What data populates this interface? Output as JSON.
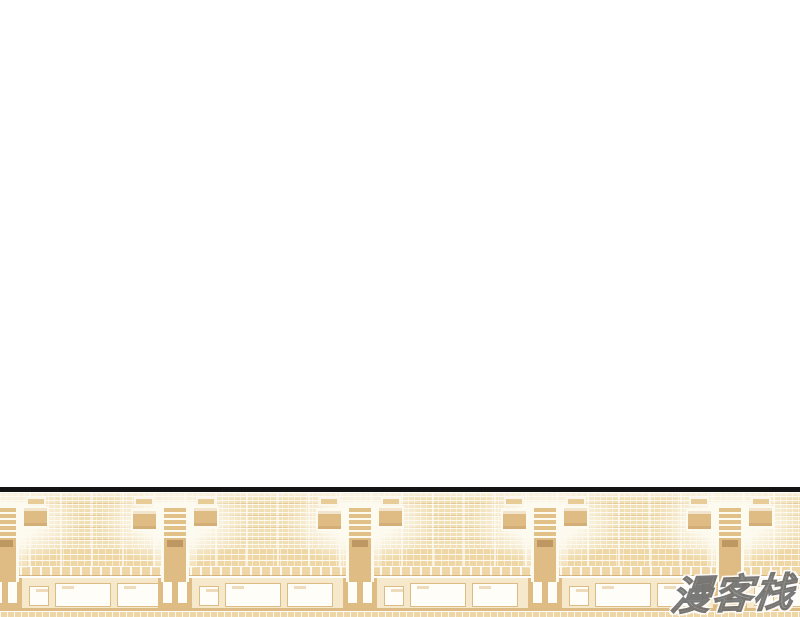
{
  "page": {
    "width": 800,
    "height": 617,
    "background_color": "#ffffff"
  },
  "panel": {
    "description": "Comic panel strip at bottom: empty stadium grandstand with tiered beige seating, entrance stairway structures and a concourse wall with white window panels",
    "top": 487,
    "height": 130,
    "border": {
      "color": "#141414",
      "height": 5
    },
    "colors": {
      "border-line": "#141414",
      "seat-base": "#f1dfb4",
      "seat-base-lower": "#eed7a4",
      "seat-dark": "#d6b27a",
      "aisle": "#fdf8ec",
      "ramp": "#dfbc83",
      "barrier": "#eed6a6",
      "wall": "#f5e8cb",
      "panel-white": "#fefdf8",
      "trim": "#ddbb84",
      "dark-accent": "#b08a55"
    },
    "geometry": {
      "vomitory_centers": [
        5,
        175,
        360,
        545,
        730
      ],
      "vomitory_width": 110,
      "bay_panels": [
        {
          "dx": 24,
          "w": 20,
          "h": 20,
          "top": 8
        },
        {
          "dx": 50,
          "w": 56,
          "h": 24,
          "top": 5
        },
        {
          "dx": 112,
          "w": 46,
          "h": 24,
          "top": 5
        }
      ],
      "ramp_door_offsets": [
        4,
        19
      ]
    }
  },
  "watermark": {
    "text": "漫客栈",
    "color": "#8f8f8f",
    "outline_color": "#ffffff",
    "edge_color": "#6b6b6b"
  }
}
